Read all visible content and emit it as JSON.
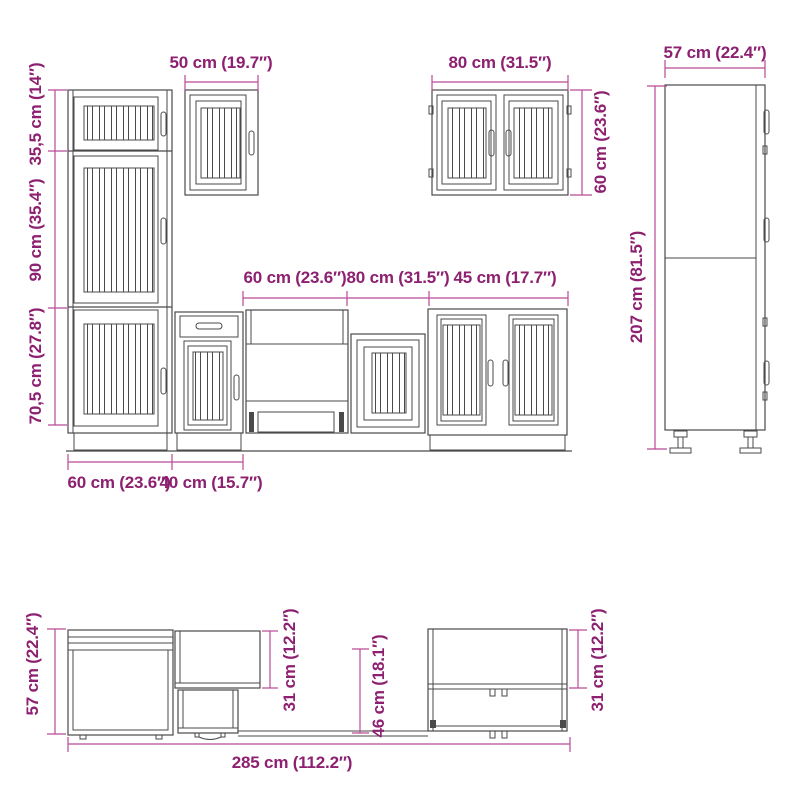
{
  "page": {
    "description": "Kitchen cabinet set dimension drawing",
    "background_color": "#ffffff",
    "label_color": "#8d2070",
    "dimension_line_color": "#b94a96",
    "drawing_line_color": "#4a4a4a"
  },
  "tall_cabinet_front": {
    "top_section_height": "35,5 cm (14″)",
    "middle_section_height": "90 cm (35.4″)",
    "bottom_section_height": "70,5 cm (27.8″)",
    "width": "60 cm (23.6″)"
  },
  "wall_cabinet_50": {
    "width": "50 cm (19.7″)"
  },
  "wall_cabinet_80": {
    "width": "80 cm (31.5″)",
    "height": "60 cm (23.6″)"
  },
  "tall_cabinet_side": {
    "depth": "57 cm (22.4″)",
    "height": "207 cm (81.5″)"
  },
  "base_cabinets": {
    "sink_cabinet_width": "60 cm (23.6″)",
    "cabinet_80_width": "80 cm (31.5″)",
    "cabinet_45_width": "45 cm (17.7″)",
    "drawer_cabinet_width": "40 cm (15.7″)"
  },
  "assembled_view": {
    "tall_cabinet_depth": "57 cm (22.4″)",
    "wall_cabinet_depth": "31 cm (12.2″)",
    "base_cabinet_depth": "46 cm (18.1″)",
    "right_cabinet_depth": "31 cm (12.2″)",
    "total_width": "285 cm (112.2″)"
  }
}
